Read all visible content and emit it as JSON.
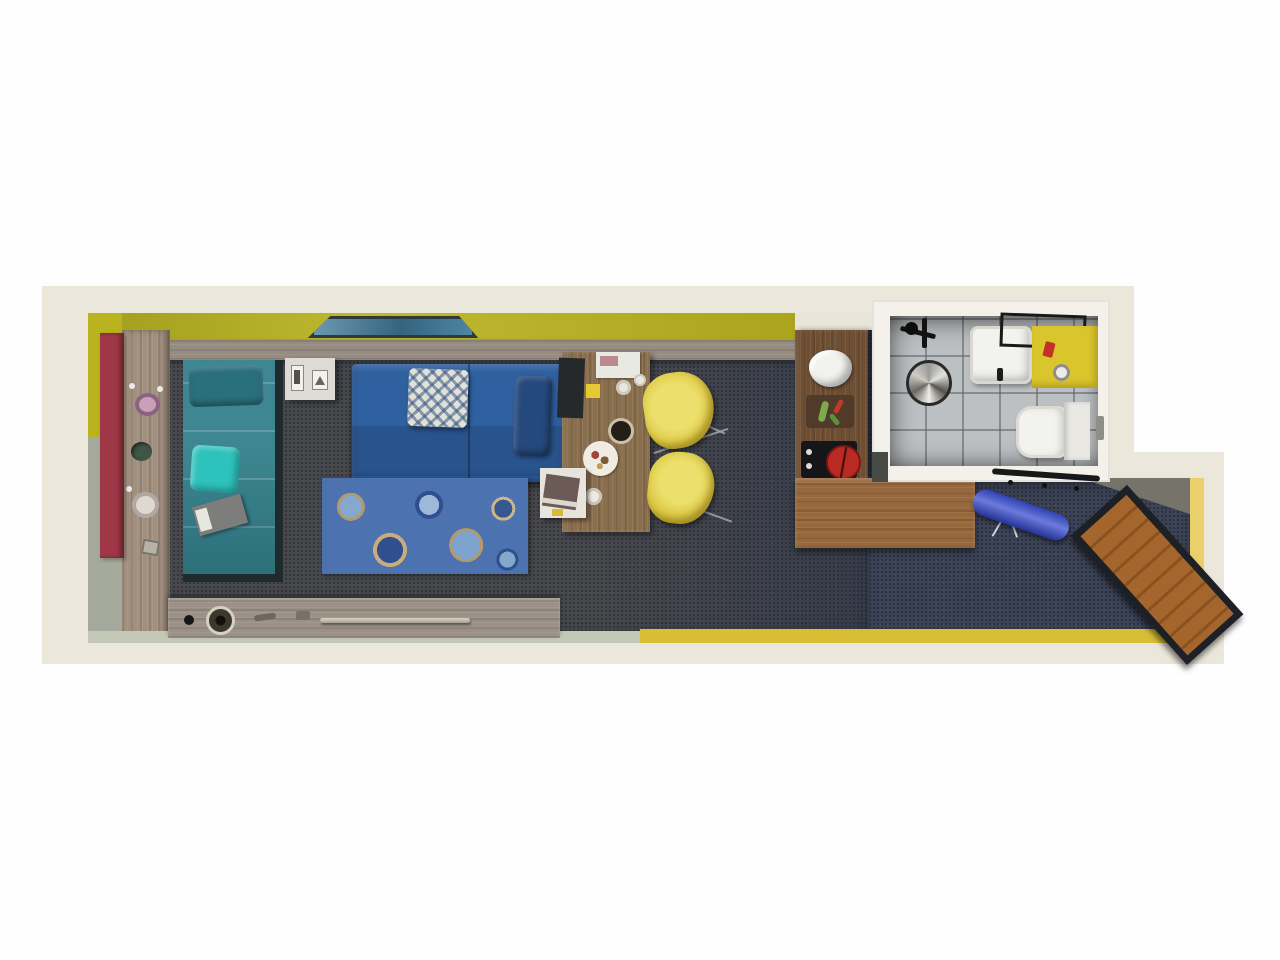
{
  "meta": {
    "title": "Top-down 3D floor plan render of a narrow studio apartment",
    "canvas": {
      "width": 1280,
      "height": 960
    },
    "visible_text": "none"
  },
  "palette": {
    "page_bg": "#fefefe",
    "wall_outer_cream": "#ebe7da",
    "wall_inner_white": "#f3f1ea",
    "wall_yellow": "#b9b31f",
    "wall_yellow_pale": "#d8be35",
    "wall_sage": "#a6aa9c",
    "wall_sage_pale": "#c4c8b6",
    "wall_yellow_reveal": "#e9d06a",
    "door_red": "#a03747",
    "wood_floor_strip": "#a2907f",
    "wood_headboard": "#968c81",
    "wood_desk": "#8a6f4e",
    "wood_counter_dark": "#6e4f33",
    "wood_counter_light": "#96683c",
    "wood_console": "#9b9186",
    "wood_bench": "#a4662c",
    "carpet_dark": "#46484d",
    "carpet_navy": "#3c4356",
    "bed_teal": "#327f8a",
    "bed_pillow_teal": "#2a6f7c",
    "cushion_bright_teal": "#2ec2bd",
    "sofa_blue": "#2f609f",
    "cushion_navy": "#25497c",
    "pillow_white": "#e0e1d8",
    "rug_blue": "#4c72b0",
    "chair_yellow": "#ddca46",
    "ironing_board_blue": "#3a4ecf",
    "tile_gray": "#bdc0c2",
    "vanity_yellow": "#d9c52c",
    "fixture_white": "#f2f2ee",
    "pot_red": "#b82a22",
    "cooktop_black": "#141619",
    "frame_dark": "#20262b",
    "painting_blue": "#4f86a2"
  },
  "rooms": [
    {
      "id": "living-sleeping",
      "label": "Living / sleeping area"
    },
    {
      "id": "kitchenette",
      "label": "Kitchenette"
    },
    {
      "id": "bathroom",
      "label": "Bathroom"
    },
    {
      "id": "entry",
      "label": "Entry corridor"
    }
  ],
  "furniture": {
    "living_sleeping": [
      "red entry door",
      "wood plank floor strip with four decor vases/plants",
      "wall painting on yellow wall",
      "single bed (teal) with pillow, bright teal cushion and book",
      "white nightstand with two framed prints",
      "sofa daybed (blue) with diamond-pattern pillow and navy bolster",
      "circle-pattern blue rug",
      "wooden desk with laptop, papers, sticky note, coffee cup, breakfast plate",
      "white side table with book",
      "two yellow shell dining chairs",
      "low wooden console with knobs and rail handle"
    ],
    "kitchenette": [
      "L-shaped wooden counter",
      "white sink basin",
      "cutting board with vegetables",
      "black cooktop with red pot"
    ],
    "bathroom": [
      "shower mixer fixture",
      "round shower head/drain",
      "white wash basin with faucet",
      "black towel rail",
      "yellow vanity counter with toiletries",
      "toilet with cistern",
      "door handle"
    ],
    "entry": [
      "black coat rack with hooks",
      "blue ironing board",
      "angled wooden storage bench"
    ],
    "chair_count": 2,
    "vase_count": 4
  }
}
